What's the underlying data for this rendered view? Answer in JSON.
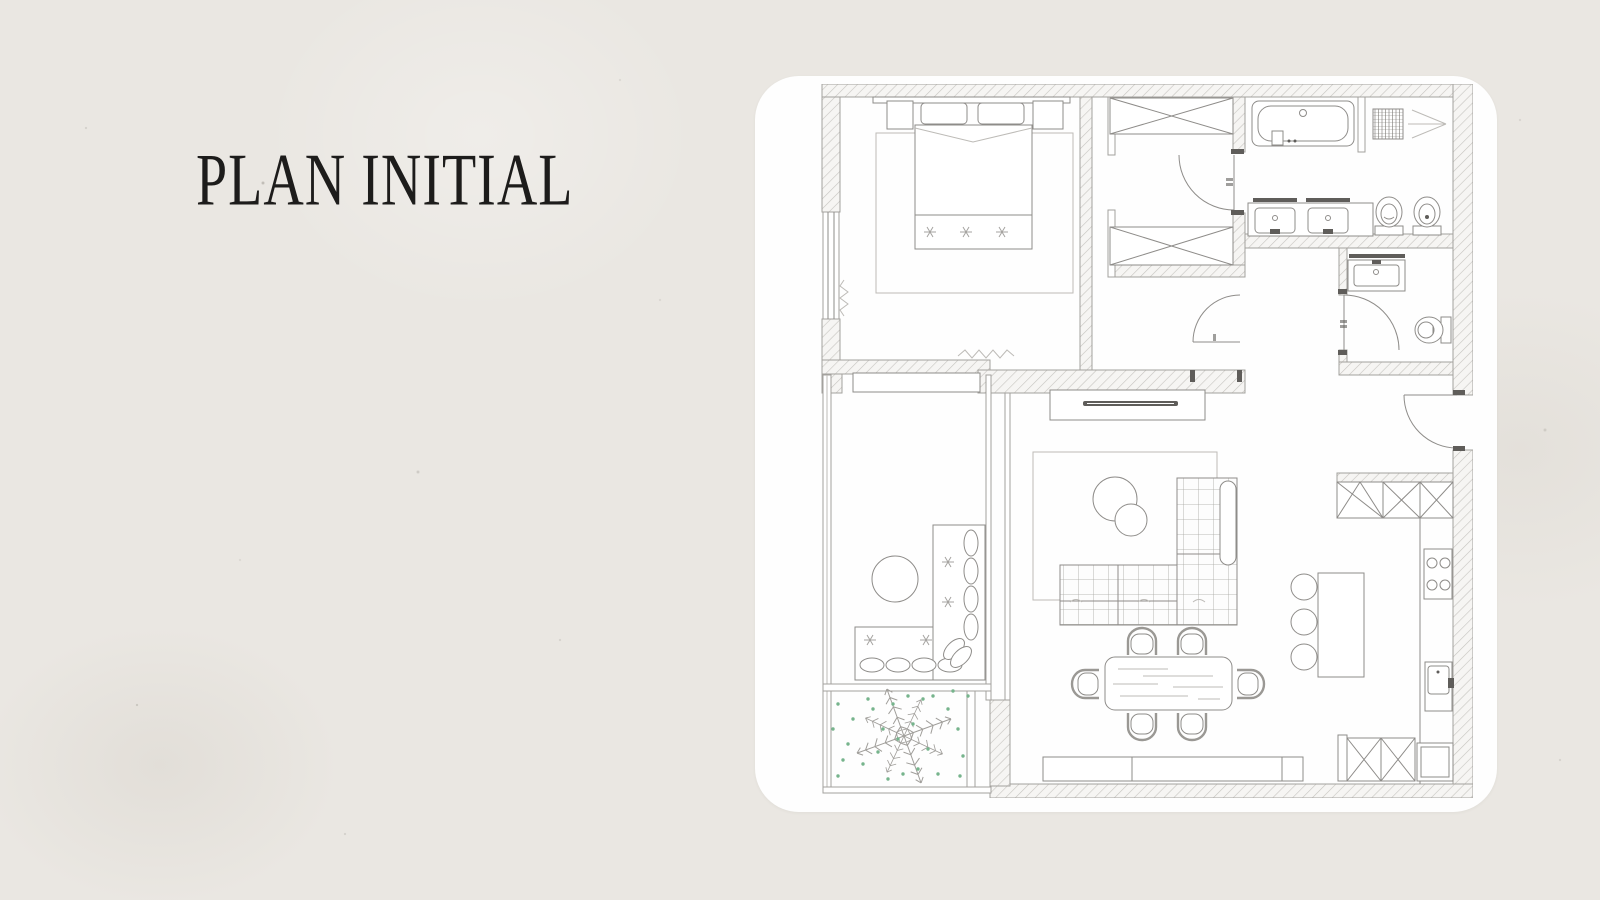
{
  "slide": {
    "title": "PLAN INITIAL"
  },
  "colors": {
    "bg": "#eae7e2",
    "card": "#fefefe",
    "ink": "#1d1c1b",
    "line": "#8e8c89",
    "linelight": "#bdbbb7",
    "wallstroke": "#a3a19d",
    "hatch": "#c6c4c0",
    "dark": "#5f5d5a",
    "grid": "#a7a5a1",
    "plant": "#76b48c"
  },
  "plan": {
    "type": "apartment-floor-plan",
    "rooms": [
      "bedroom",
      "walk-in-closet",
      "bathroom",
      "wc",
      "hallway",
      "lounge-office",
      "living-room",
      "dining-area",
      "kitchen",
      "balcony"
    ],
    "fixtures": [
      "double-bed",
      "nightstands",
      "headboard",
      "area-rug",
      "wardrobes",
      "bathtub",
      "shower",
      "double-washbasin",
      "toilet",
      "bidet",
      "washbasin",
      "tv-console",
      "corner-sofa",
      "coffee-tables",
      "dining-table",
      "dining-chairs",
      "sideboard",
      "kitchen-upper-cabinets",
      "cooktop",
      "kitchen-sink",
      "kitchen-island",
      "bar-stools",
      "fridge-cabinet",
      "lounge-sofa",
      "round-side-table",
      "balcony-plant",
      "entrance-door",
      "interior-doors",
      "windows"
    ]
  }
}
